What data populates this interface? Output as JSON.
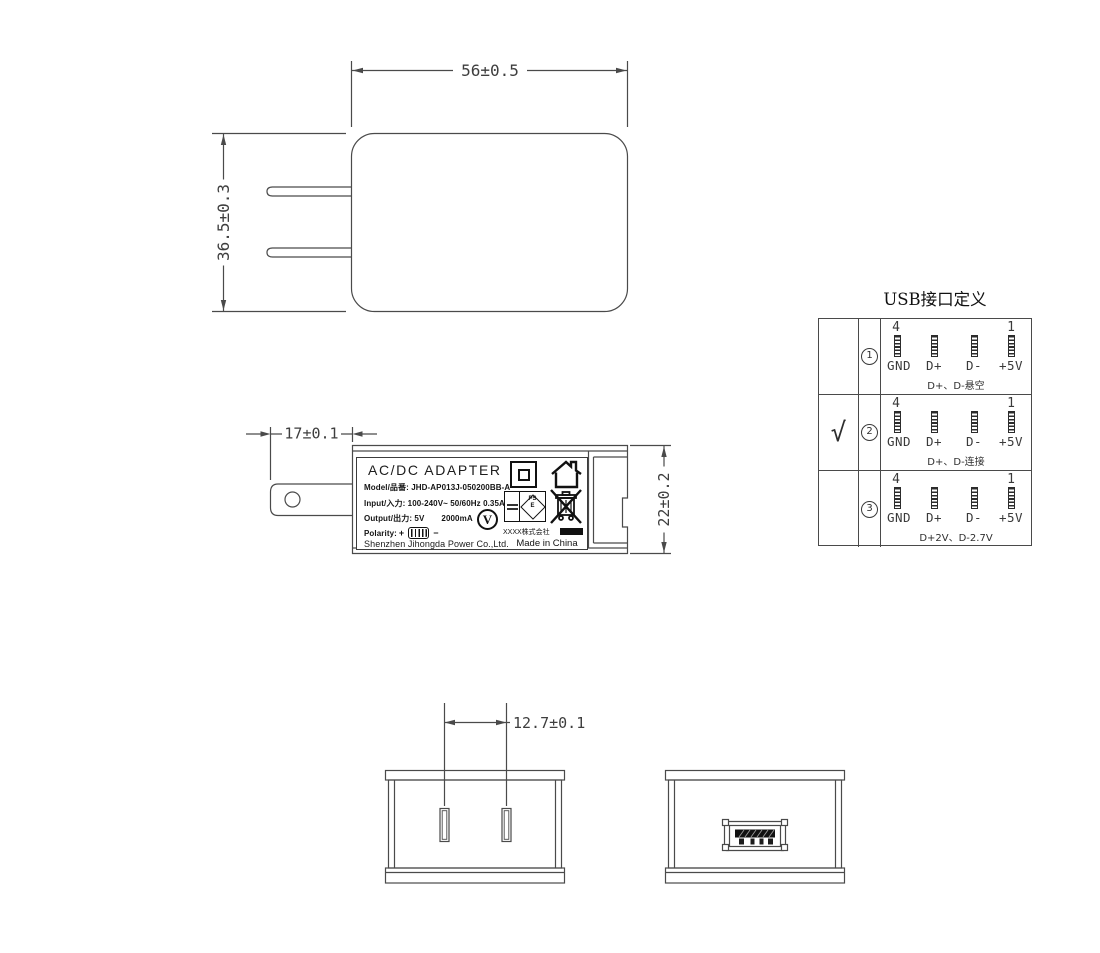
{
  "front_view": {
    "width_dim": "56±0.5",
    "height_dim": "36.5±0.3"
  },
  "side_view": {
    "prong_dim": "17±0.1",
    "height_dim": "22±0.2",
    "label": {
      "title": "AC/DC  ADAPTER",
      "model": "Model/品番: JHD-AP013J-050200BB-A",
      "input": "Input/入力: 100-240V~  50/60Hz  0.35A",
      "output_prefix": "Output/出力: 5V",
      "output_suffix": "2000mA",
      "polarity_label": "Polarity:",
      "polarity_plus": "+",
      "polarity_minus": "−",
      "company": "Shenzhen Jihongda Power Co.,Ltd.",
      "v_mark": "V",
      "pse_line1": "PS",
      "pse_line2": "E",
      "company_jp": "XXXX株式会社",
      "made_in": "Made in China"
    }
  },
  "bottom_views": {
    "pin_pitch_dim": "12.7±0.1"
  },
  "usb_table": {
    "title": "USB接口定义",
    "pin_numbers": {
      "left": "4",
      "right": "1"
    },
    "pin_labels": [
      "GND",
      "D+",
      "D-",
      "+5V"
    ],
    "rows": [
      {
        "check": "",
        "num": "1",
        "note": "D+、D-悬空"
      },
      {
        "check": "√",
        "num": "2",
        "note": "D+、D-连接"
      },
      {
        "check": "",
        "num": "3",
        "note": "D+2V、D-2.7V"
      }
    ]
  }
}
